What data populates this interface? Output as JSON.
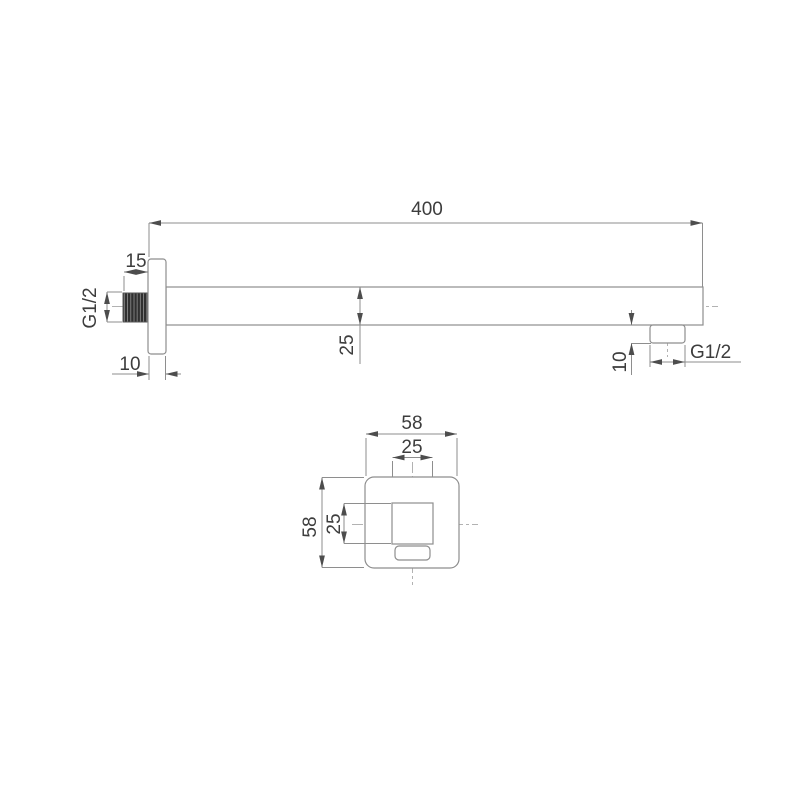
{
  "drawing": {
    "side_view": {
      "overall_length": "400",
      "thread_length": "15",
      "inlet_thread": "G1/2",
      "plate_thickness": "10",
      "arm_profile": "25",
      "outlet_height": "10",
      "outlet_thread": "G1/2"
    },
    "front_view": {
      "plate_width": "58",
      "arm_width": "25",
      "plate_height": "58",
      "arm_height": "25"
    },
    "colors": {
      "background": "#ffffff",
      "outline": "#8e8e8e",
      "dimension_line": "#8e8e8e",
      "centerline": "#b2b2b2",
      "arrow": "#4d4d4d",
      "text": "#3d3d3d",
      "thread_fill": "#303030"
    }
  }
}
